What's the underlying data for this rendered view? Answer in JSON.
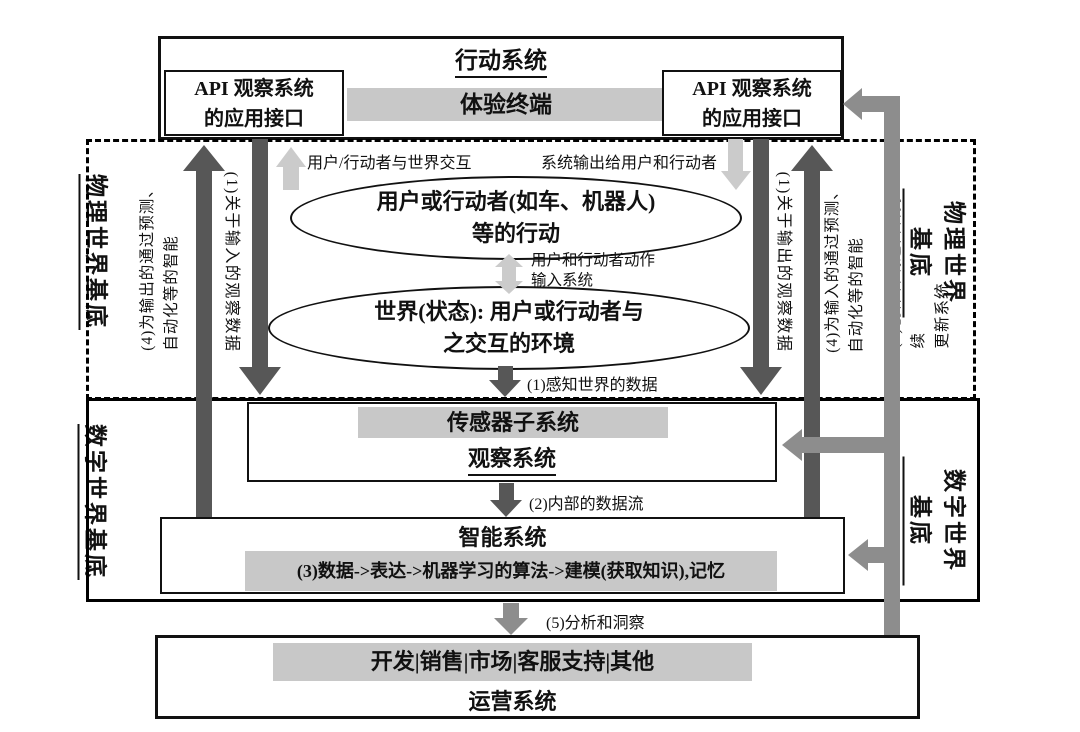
{
  "palette": {
    "bar_gray": "#c8c8c8",
    "light_arrow": "#cbcbcb",
    "dark_arrow": "#575757",
    "mid_arrow": "#8d8d8d",
    "line_black": "#111111"
  },
  "action_system": {
    "title": "行动系统",
    "api_box_left": "API 观察系统\n的应用接口",
    "api_box_right": "API 观察系统\n的应用接口",
    "experience_terminal": "体验终端"
  },
  "physical_world": {
    "label_left": "物理世界基底",
    "label_right": "物理世界基底",
    "interaction_caption_left": "用户/行动者与世界交互",
    "interaction_caption_right": "系统输出给用户和行动者",
    "actor_ellipse": "用户或行动者(如车、机器人)\n等的行动",
    "action_input_caption": "用户和行动者动作\n输入系统",
    "world_ellipse": "世界(状态): 用户或行动者与\n之交互的环境",
    "perception_caption": "(1)感知世界的数据"
  },
  "annotations": {
    "left_input_observation": "(1)关于输入的观察数据",
    "left_output_intelligence": "(4)为输出的通过预测、\n自动化等的智能",
    "right_output_observation": "(1)关于输出的观察数据",
    "right_input_intelligence": "(4)为输入的通过预测、\n自动化等的智能",
    "creator_update": "(6)创作者或运营者持续\n更新系统"
  },
  "digital_world": {
    "label_left": "数字世界基底",
    "label_right": "数字世界基底",
    "observation_box": {
      "sensor_bar": "传感器子系统",
      "title": "观察系统"
    },
    "internal_flow_caption": "(2)内部的数据流",
    "intelligence_box": {
      "title": "智能系统",
      "pipeline_bar": "(3)数据->表达->机器学习的算法->建模(获取知识),记忆"
    }
  },
  "operations": {
    "insight_caption": "(5)分析和洞察",
    "functions_bar": "开发|销售|市场|客服支持|其他",
    "title": "运营系统"
  }
}
